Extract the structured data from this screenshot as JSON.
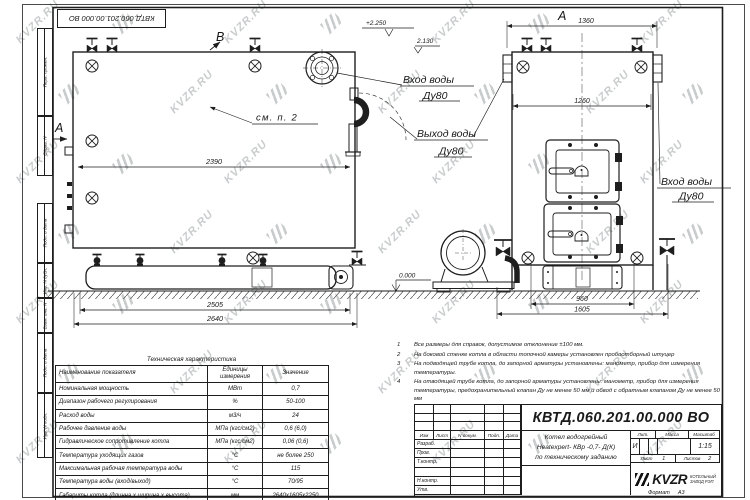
{
  "watermark": {
    "text": "KVZR.RU"
  },
  "stamp_top": {
    "doc_number": "КВТД.060.201.00.000 ВО"
  },
  "margin_labels": {
    "perv": "Перв. примен.",
    "sprav": "Справ. N",
    "podp1": "Подп. и дата",
    "inv_dubl": "Инв. N дубл.",
    "vzam": "Взам. инв. N",
    "podp2": "Подп. и дата",
    "inv_podl": "Инв. N подл."
  },
  "drawing": {
    "view_b": "В",
    "view_a": "А",
    "view_front": "А",
    "dim_2390": "2390",
    "dim_2505": "2505",
    "dim_2640": "2640",
    "dim_1360": "1360",
    "dim_1260": "1260",
    "dim_960": "960",
    "dim_1605": "1605",
    "elev_top": "+2.250",
    "elev_mid": "2.130",
    "elev_zero": "0.000",
    "see_note": "см. п. 2",
    "inlet_side_label": "Вход воды",
    "inlet_side_dn": "Ду80",
    "outlet_label": "Выход воды",
    "outlet_dn": "Ду80",
    "inlet_front_label": "Вход воды",
    "inlet_front_dn": "Ду80"
  },
  "tech_table": {
    "title": "Техническая характеристика",
    "headers": {
      "name": "Наименование показателя",
      "units": "Единицы измерения",
      "value": "Значение"
    },
    "rows": [
      {
        "name": "Номинальная мощность",
        "units": "МВт",
        "value": "0,7"
      },
      {
        "name": "Диапазон рабочего регулирования",
        "units": "%",
        "value": "50-100"
      },
      {
        "name": "Расход воды",
        "units": "м3/ч",
        "value": "24"
      },
      {
        "name": "Рабочее давление воды",
        "units": "МПа (кгс/см2)",
        "value": "0,6 (6,0)"
      },
      {
        "name": "Гидравлическое сопротивление котла",
        "units": "МПа (кгс/см2)",
        "value": "0,06 (0,6)"
      },
      {
        "name": "Температура уходящих газов",
        "units": "°С",
        "value": "не более 250"
      },
      {
        "name": "Максимальная рабочая температура воды",
        "units": "°С",
        "value": "115"
      },
      {
        "name": "Температура воды (вход/выход)",
        "units": "°С",
        "value": "70/95"
      },
      {
        "name": "Габариты котла (длинна х ширина х высота)",
        "units": "мм",
        "value": "2640х1605х2250"
      }
    ]
  },
  "notes": {
    "items": [
      {
        "num": "1",
        "text": "Все размеры для справок, допустимое отклонение ±100 мм."
      },
      {
        "num": "2",
        "text": "На боковой стенке котла в области топочной камеры установлен пробоотборный штуцер"
      },
      {
        "num": "3",
        "text": "На подводящей трубе котла, до запорной арматуры установлены: манометр, прибор для измерения температуры."
      },
      {
        "num": "4",
        "text": "На отводящей трубе котла, до запорной арматуры установлены: манометр, прибор для измерения температуры, предохранительный клапан Ду не менее 50 мм и обвод с обратным клапаном Ду не менее 50 мм"
      }
    ]
  },
  "title_block": {
    "doc_number": "КВТД.060.201.00.000 ВО",
    "name_line1": "Котел водогрейный",
    "name_line2": "Heatexpert- КВр -0,7- Д(К)",
    "name_line3": "по техническому заданию",
    "col_izm": "Изм",
    "col_list": "Лист",
    "col_doc": "N докум.",
    "col_podp": "Подп.",
    "col_data": "Дата",
    "row_razrab": "Разраб.",
    "row_prov": "Пров.",
    "row_tkontr": "Т.контр.",
    "row_nkontr": "Н.контр.",
    "row_utv": "Утв.",
    "lit_header": "Лит.",
    "mass_header": "Масса",
    "scale_header": "Масштаб",
    "lit_value": "И",
    "scale_value": "1:15",
    "sheet_label": "Лист",
    "sheet_value": "1",
    "sheets_label": "Листов",
    "sheets_value": "2",
    "logo_text": "KVZR",
    "logo_caption1": "КОТЕЛЬНЫЙ",
    "logo_caption2": "ЗАВОД РЭП",
    "format_label": "Формат",
    "format_value": "А3"
  }
}
